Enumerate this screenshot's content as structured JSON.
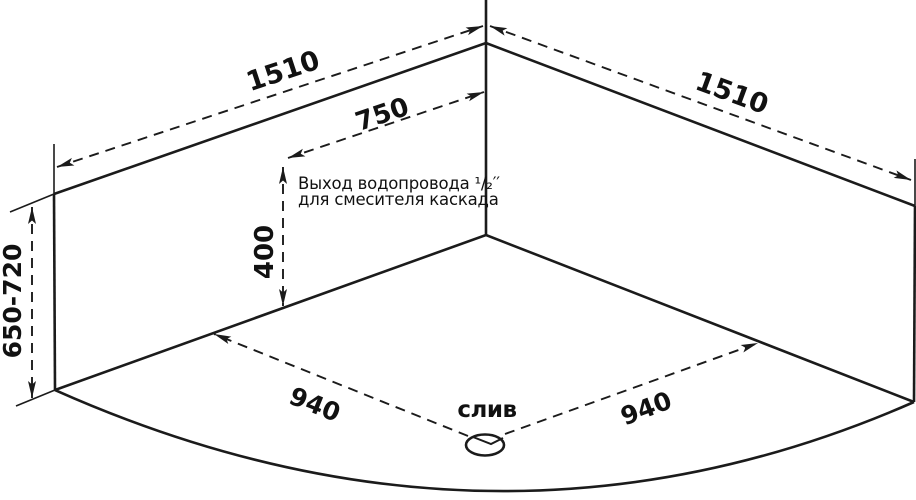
{
  "diagram": {
    "type": "corner-bathtub-dimension-drawing",
    "dimensions": {
      "rim_left": "1510",
      "rim_right": "1510",
      "outlet_offset": "750",
      "outlet_height": "400",
      "install_height": "650-720",
      "drain_left": "940",
      "drain_right": "940"
    },
    "labels": {
      "outlet_line1": "Выход водопровода ¹/₂′′",
      "outlet_line2": "для смесителя каскада",
      "drain": "слив"
    },
    "colors": {
      "line": "#1b1b1b",
      "background": "#ffffff"
    }
  }
}
